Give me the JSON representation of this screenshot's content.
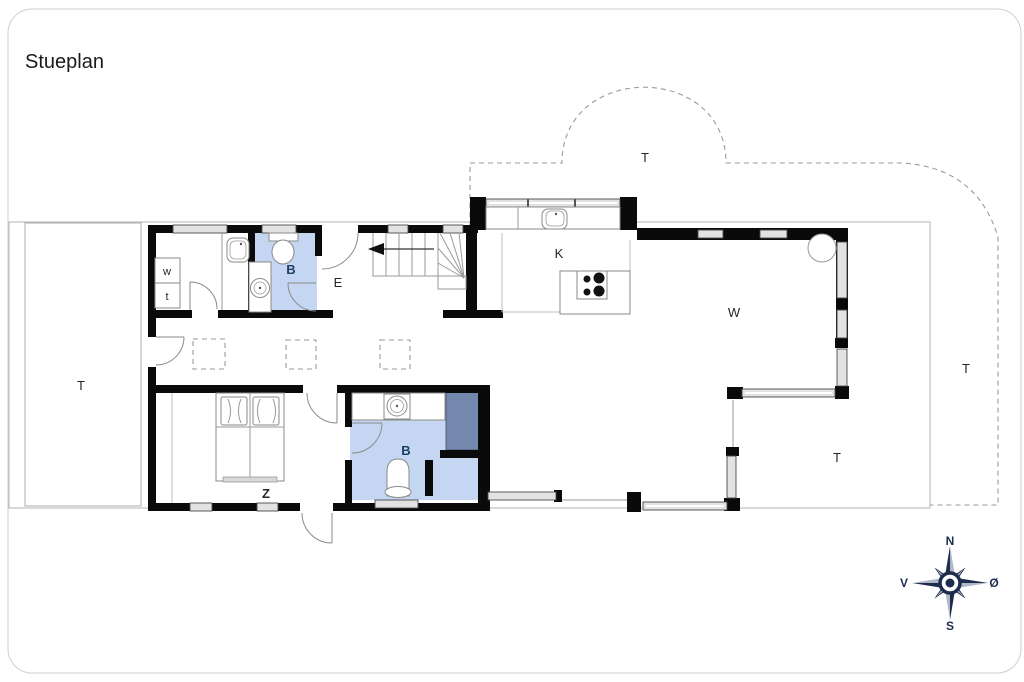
{
  "title": "Stueplan",
  "labels": {
    "terrace": "T",
    "washer": "w",
    "dryer": "t",
    "bath": "B",
    "entry": "E",
    "kitchen": "K",
    "living": "W",
    "bedroom": "Z"
  },
  "compass": {
    "north": "N",
    "south": "S",
    "west": "V",
    "east": "Ø"
  },
  "colors": {
    "wall": "#0a0a0a",
    "bath_fill": "#c5d6f2",
    "shower_fill": "#7488ad",
    "label_blue": "#1c3f63",
    "compass_navy": "#1e2c4e",
    "compass_silver": "#b0b8c6"
  }
}
